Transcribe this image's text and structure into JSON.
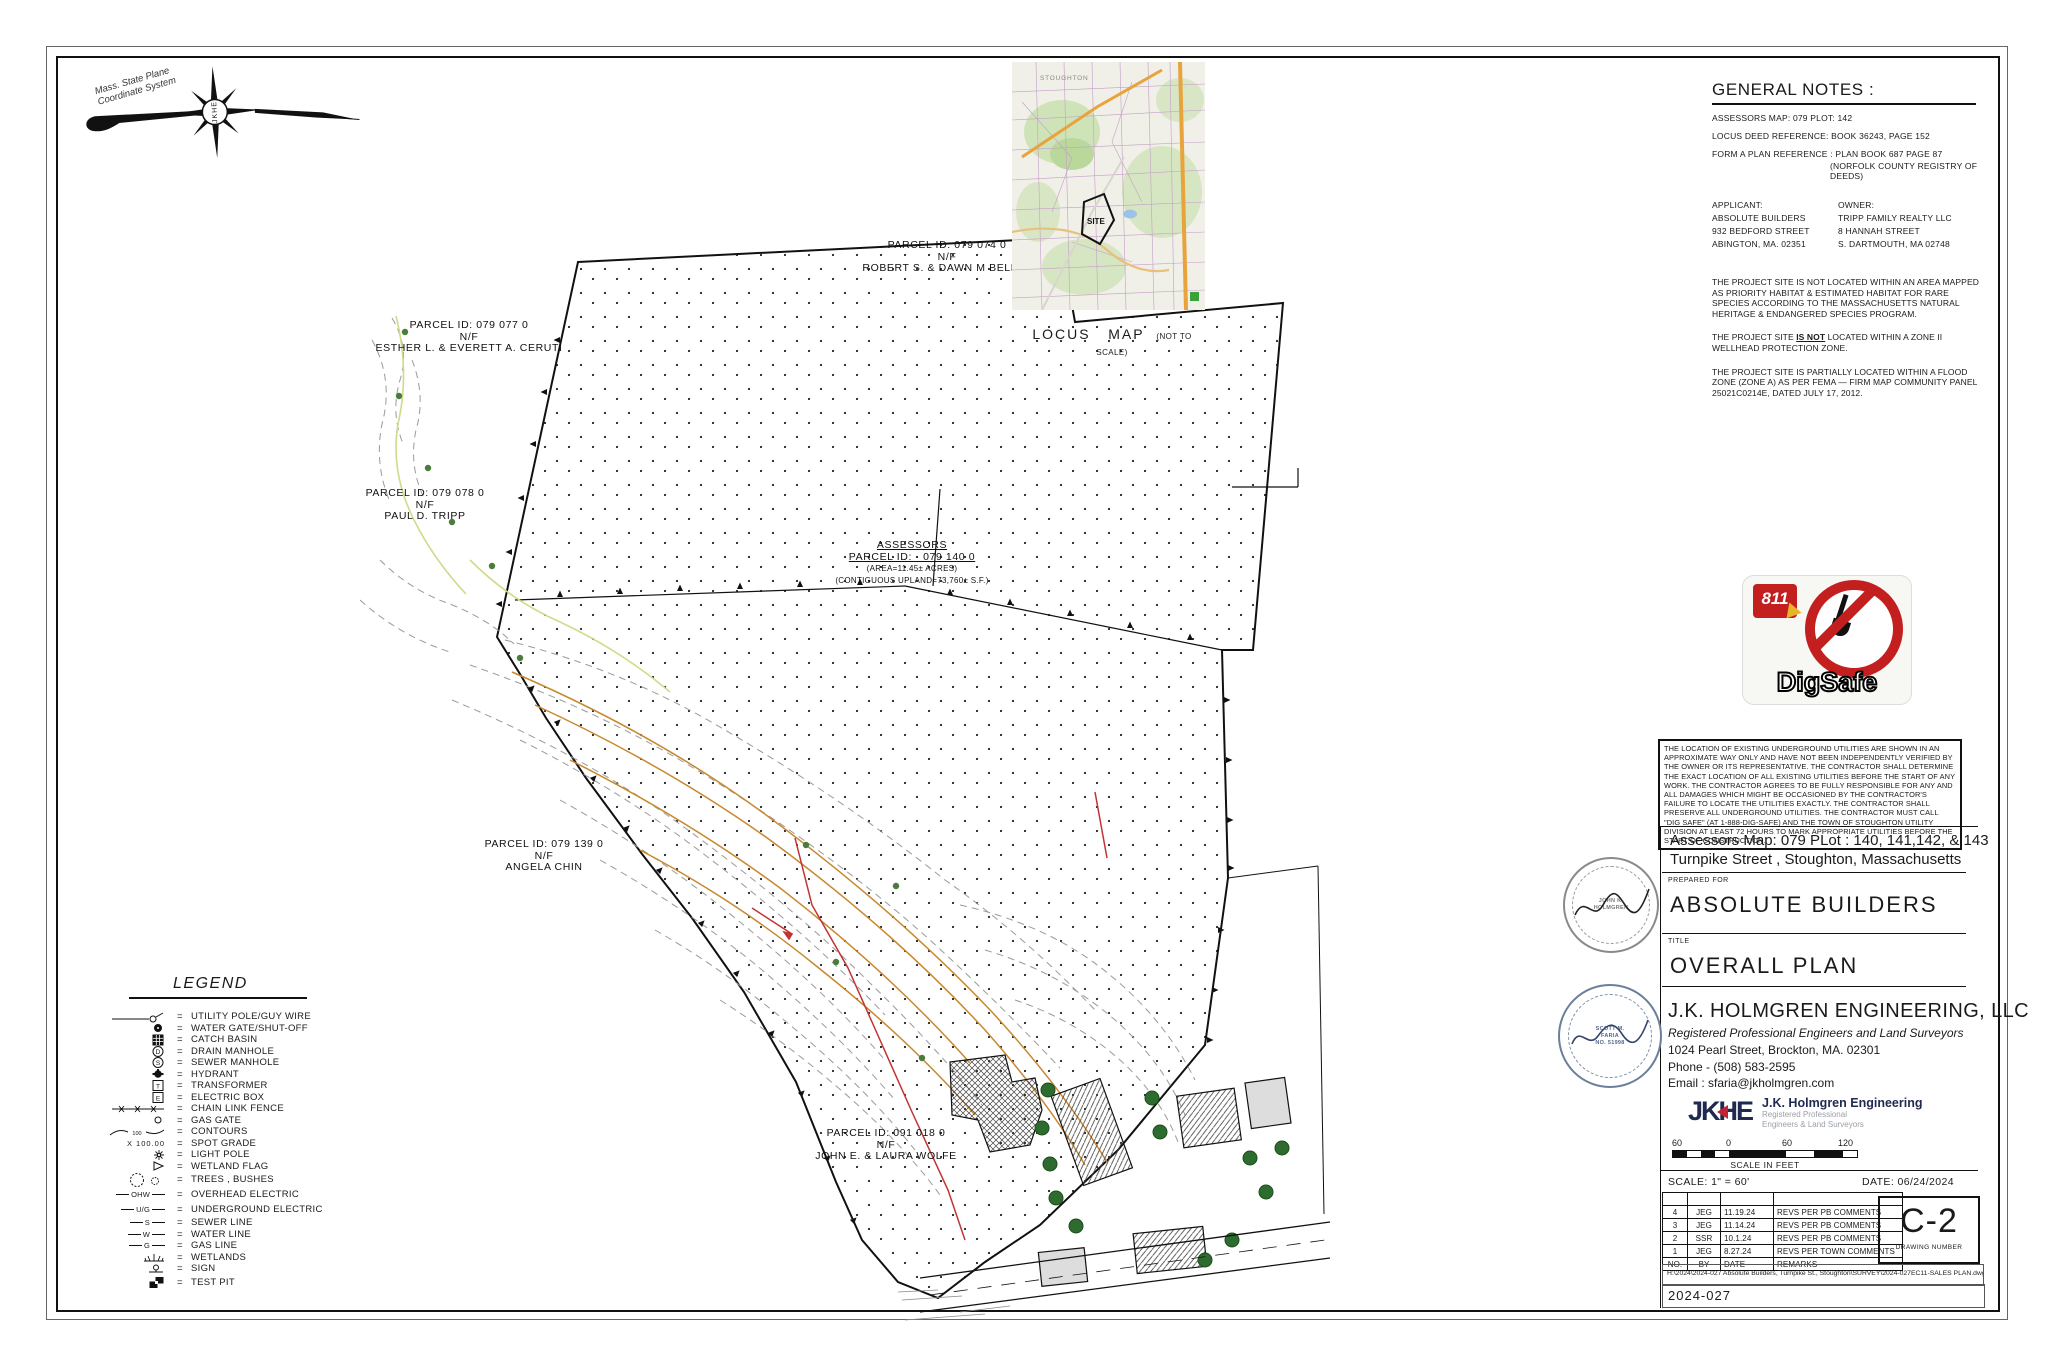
{
  "north_arrow": {
    "label_line1": "Mass. State Plane",
    "label_line2": "Coordinate System",
    "hub": "JKHE"
  },
  "locus": {
    "town": "STOUGHTON",
    "site": "SITE",
    "caption_1": "LOCUS",
    "caption_2": "MAP",
    "caption_note": "(NOT TO SCALE)"
  },
  "general_notes": {
    "heading": "GENERAL NOTES :",
    "assessors": "ASSESSORS MAP: 079    PLOT: 142",
    "deed": "LOCUS DEED REFERENCE: BOOK 36243, PAGE 152",
    "form_a_1": "FORM A PLAN REFERENCE : PLAN BOOK 687 PAGE 87",
    "form_a_2": "(NORFOLK COUNTY REGISTRY OF DEEDS)",
    "applicant_label": "APPLICANT:",
    "applicant_1": "ABSOLUTE BUILDERS",
    "applicant_2": "932 BEDFORD STREET",
    "applicant_3": "ABINGTON, MA. 02351",
    "owner_label": "OWNER:",
    "owner_1": "TRIPP FAMILY REALTY LLC",
    "owner_2": "8 HANNAH STREET",
    "owner_3": "S. DARTMOUTH, MA 02748",
    "note_habitat": "THE PROJECT SITE IS NOT LOCATED WITHIN AN AREA MAPPED AS PRIORITY HABITAT & ESTIMATED HABITAT FOR RARE SPECIES ACCORDING TO THE MASSACHUSETTS NATURAL HERITAGE & ENDANGERED SPECIES PROGRAM.",
    "note_wellhead_pre": "THE PROJECT SITE ",
    "note_wellhead_underline": "IS NOT",
    "note_wellhead_post": " LOCATED WITHIN A ZONE II WELLHEAD PROTECTION ZONE.",
    "note_flood": "THE PROJECT SITE IS PARTIALLY LOCATED WITHIN A FLOOD ZONE (ZONE A) AS PER FEMA — FIRM MAP COMMUNITY PANEL 25021C0214E, DATED JULY 17, 2012."
  },
  "parcels": {
    "p074": {
      "id": "PARCEL ID: 079 074 0",
      "nf": "N/F",
      "owner": "ROBERT S. & DAWN M BELLAY"
    },
    "p077": {
      "id": "PARCEL ID: 079 077 0",
      "nf": "N/F",
      "owner": "ESTHER L. & EVERETT A. CERUTI"
    },
    "p078": {
      "id": "PARCEL ID: 079 078 0",
      "nf": "N/F",
      "owner": "PAUL D. TRIPP"
    },
    "p139": {
      "id": "PARCEL ID: 079 139 0",
      "nf": "N/F",
      "owner": "ANGELA CHIN"
    },
    "p018": {
      "id": "PARCEL ID: 091 018 0",
      "nf": "N/F",
      "owner": "JOHN E. & LAURA WOLFE"
    },
    "main": {
      "line1": "ASSESSORS",
      "line2": "PARCEL ID: · 079 140 0",
      "line3": "(AREA=11.45± ACRES)",
      "line4": "(CONTIGUOUS UPLAND=73,760± S.F.)"
    }
  },
  "digsafe": {
    "number": "811",
    "name": "DigSafe"
  },
  "utility_note": "THE LOCATION OF EXISTING UNDERGROUND UTILITIES ARE SHOWN IN AN APPROXIMATE WAY ONLY AND HAVE NOT BEEN INDEPENDENTLY VERIFIED BY THE OWNER OR ITS REPRESENTATIVE.  THE CONTRACTOR SHALL DETERMINE THE EXACT LOCATION OF ALL EXISTING UTILITIES BEFORE THE START OF ANY WORK.  THE CONTRACTOR AGREES TO BE FULLY RESPONSIBLE FOR ANY AND ALL DAMAGES WHICH MIGHT BE OCCASIONED BY THE CONTRACTOR'S FAILURE TO LOCATE THE UTILITIES EXACTLY.  THE CONTRACTOR SHALL PRESERVE ALL UNDERGROUND UTILITIES.  THE CONTRACTOR MUST CALL \"DIG SAFE\" (AT 1-888-DIG-SAFE)  AND THE TOWN OF STOUGHTON UTILITY DIVISION AT LEAST 72 HOURS TO MARK APPROPRIATE UTILITIES BEFORE THE START OF CONSTRUCTION.",
  "title_block": {
    "assessors_line": "Assessors Map: 079  PLot : 140, 141,142, & 143",
    "address_line": "Turnpike Street , Stoughton, Massachusetts",
    "prepared_for_label": "PREPARED FOR",
    "prepared_for": "ABSOLUTE  BUILDERS",
    "title_label": "TITLE",
    "title": "OVERALL   PLAN",
    "firm": "J.K. HOLMGREN ENGINEERING, LLC",
    "firm_sub": "Registered Professional Engineers and Land Surveyors",
    "firm_addr": "1024 Pearl Street, Brockton, MA. 02301",
    "firm_phone": "Phone - (508) 583-2595",
    "firm_email": "Email : sfaria@jkholmgren.com",
    "logo_text": "JKHE",
    "logo_name": "J.K. Holmgren Engineering",
    "logo_sub1": "Registered Professional",
    "logo_sub2": "Engineers & Land Surveyors",
    "scale_ticks": [
      "60",
      "0",
      "60",
      "120"
    ],
    "scale_caption": "SCALE IN FEET",
    "scale_note": "SCALE:  1\" = 60'",
    "date": "DATE:  06/24/2024",
    "drawing_number": "C-2",
    "drawing_number_label": "DRAWING NUMBER",
    "file_path": "H:\\2024\\2024-027 Absolute Builders, Turnpike St., Stoughton\\SURVEY\\2024-027EC11-SALES PLAN.dwg",
    "project_number": "2024-027"
  },
  "revisions": {
    "header": {
      "no": "NO.",
      "by": "BY",
      "date": "DATE",
      "remarks": "REMARKS"
    },
    "rows": [
      {
        "no": "4",
        "by": "JEG",
        "date": "11.19.24",
        "remarks": "REVS PER PB COMMENTS"
      },
      {
        "no": "3",
        "by": "JEG",
        "date": "11.14.24",
        "remarks": "REVS PER PB COMMENTS"
      },
      {
        "no": "2",
        "by": "SSR",
        "date": "10.1.24",
        "remarks": "REVS PER PB COMMENTS"
      },
      {
        "no": "1",
        "by": "JEG",
        "date": "8.27.24",
        "remarks": "REVS PER TOWN COMMENTS"
      }
    ]
  },
  "seals": {
    "seal1_line1": "JOHN K.",
    "seal1_line2": "HOLMGREN",
    "seal2_line1": "SCOTT M.",
    "seal2_line2": "FARIA",
    "seal2_no": "NO. 51998"
  },
  "legend": {
    "title": "LEGEND",
    "eq": "=",
    "contour_num": "100",
    "spot_grade_text": "X   100.00",
    "items": [
      {
        "label": "UTILITY POLE/GUY WIRE"
      },
      {
        "label": "WATER GATE/SHUT-OFF"
      },
      {
        "label": "CATCH BASIN"
      },
      {
        "label": "DRAIN MANHOLE"
      },
      {
        "label": "SEWER MANHOLE"
      },
      {
        "label": "HYDRANT"
      },
      {
        "label": "TRANSFORMER"
      },
      {
        "label": "ELECTRIC BOX"
      },
      {
        "label": "CHAIN LINK FENCE"
      },
      {
        "label": "GAS GATE"
      },
      {
        "label": "CONTOURS"
      },
      {
        "label": "SPOT GRADE"
      },
      {
        "label": "LIGHT POLE"
      },
      {
        "label": "WETLAND FLAG"
      },
      {
        "label": "TREES , BUSHES"
      },
      {
        "label": "OVERHEAD ELECTRIC",
        "tag": "OHW"
      },
      {
        "label": "UNDERGROUND ELECTRIC",
        "tag": "U/G"
      },
      {
        "label": "SEWER LINE",
        "tag": "S"
      },
      {
        "label": "WATER LINE",
        "tag": "W"
      },
      {
        "label": "GAS LINE",
        "tag": "G"
      },
      {
        "label": "WETLANDS"
      },
      {
        "label": "SIGN"
      },
      {
        "label": "TEST PIT"
      }
    ]
  }
}
